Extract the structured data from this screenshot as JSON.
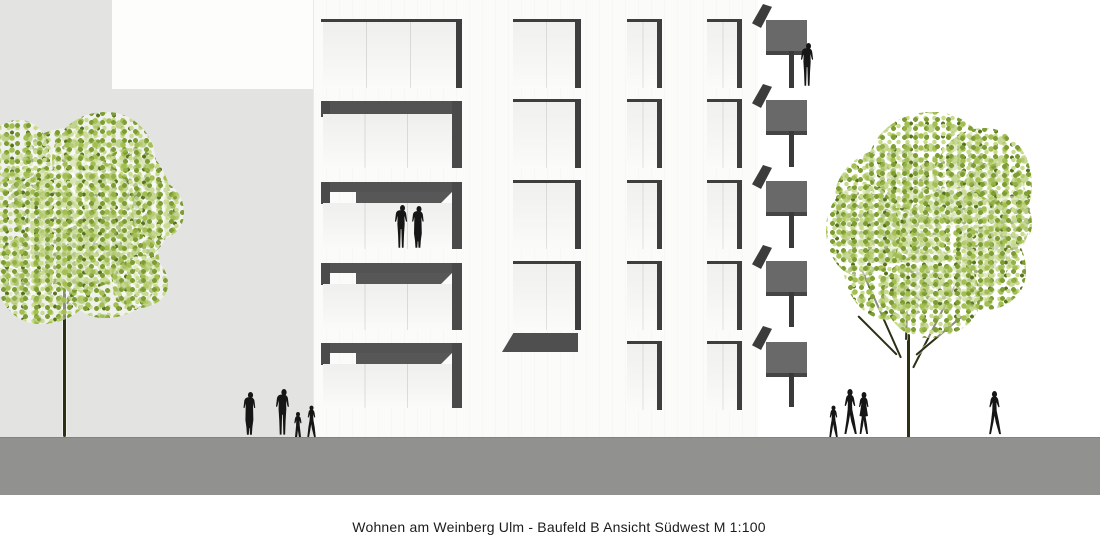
{
  "caption": "Wohnen am Weinberg Ulm - Baufeld B Ansicht Südwest M 1:100",
  "drawing": {
    "project": "Wohnen am Weinberg Ulm",
    "site": "Baufeld B",
    "view": "Ansicht Südwest",
    "scale": "M 1:100",
    "type": "architectural-elevation"
  },
  "scene": {
    "building": {
      "floors": 5,
      "loggia_bays_left": 1,
      "window_columns": 3,
      "side_balconies_right": 5,
      "entrance_canopy": 1
    },
    "trees": [
      "left-street-tree",
      "right-street-tree"
    ],
    "people": {
      "left_sidewalk_figures": 4,
      "loggia_figures": 2,
      "balcony_figures": 1,
      "right_sidewalk_group": 3,
      "right_single_walker": 1
    },
    "colors": {
      "background_gray": "#e3e3e1",
      "facade_white": "#fbfbf9",
      "window_frame_dark": "#3e3e3e",
      "loggia_band_gray": "#535353",
      "balcony_gray": "#696969",
      "ground_gray": "#919190",
      "leaf_light": "#c9dc8e",
      "leaf_mid": "#a3bf52",
      "leaf_dark": "#56741f",
      "trunk_dark": "#2c3014",
      "silhouette_black": "#161616",
      "caption_text": "#1c1c1c"
    }
  }
}
